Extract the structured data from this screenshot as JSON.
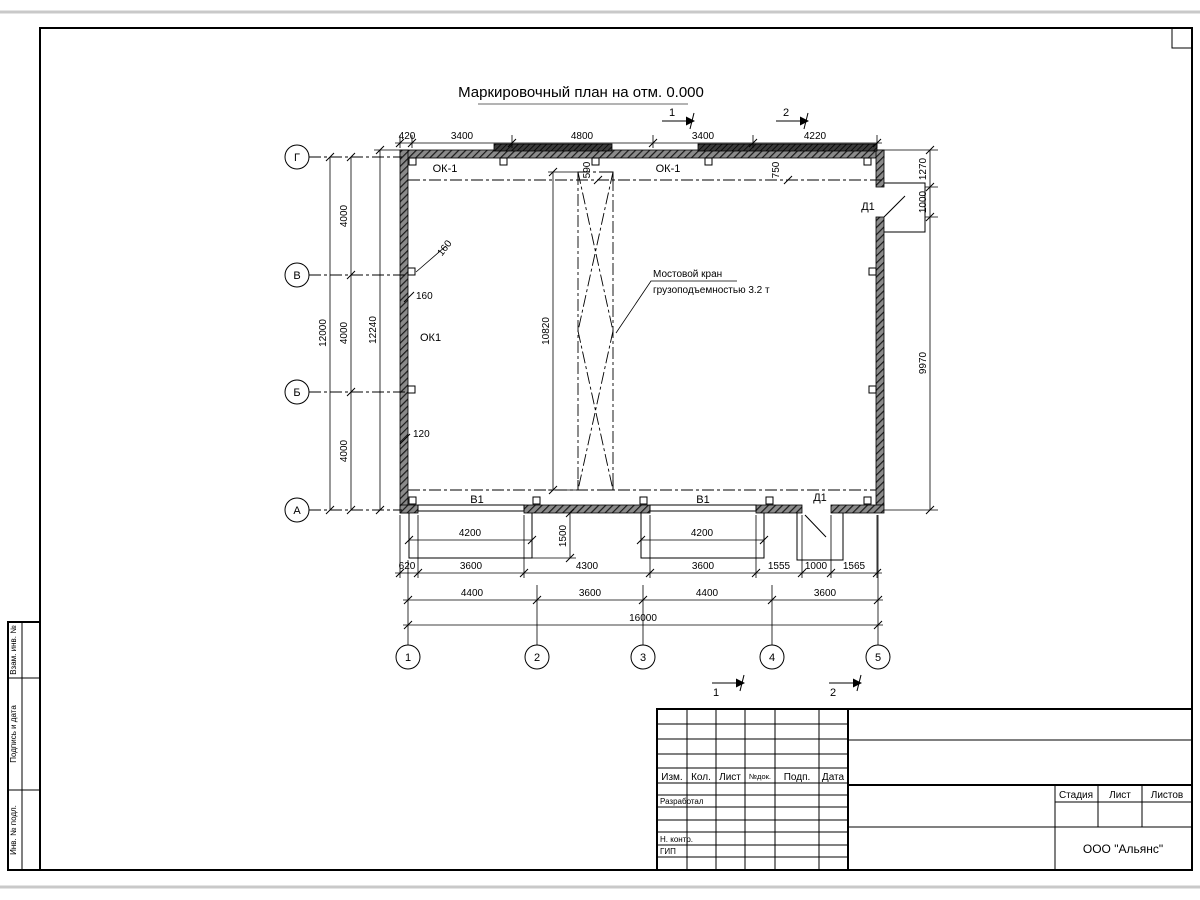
{
  "title": "Маркировочный план на отм. 0.000",
  "axes": {
    "cols": [
      "1",
      "2",
      "3",
      "4",
      "5"
    ],
    "rows": [
      "Г",
      "В",
      "Б",
      "А"
    ]
  },
  "dims": {
    "top": [
      "420",
      "3400",
      "4800",
      "3400",
      "4220"
    ],
    "left": {
      "total": "12000",
      "spans": [
        "4000",
        "4000",
        "4000"
      ],
      "overall": "12240"
    },
    "right": [
      "1270",
      "1000",
      "9970"
    ],
    "crane": {
      "length": "10820",
      "offset_left": "590",
      "offset_right": "750"
    },
    "wall_leaders": [
      "160",
      "160",
      "120"
    ],
    "aprons": [
      "4200",
      "4200"
    ],
    "apron_depth": "1500",
    "bottom_row1": [
      "620",
      "3600",
      "4300",
      "3600",
      "1555",
      "1000",
      "1565"
    ],
    "bottom_row2": [
      "4400",
      "3600",
      "4400",
      "3600"
    ],
    "bottom_total": "16000"
  },
  "marks": {
    "windows_top": [
      "ОК-1",
      "ОК-1"
    ],
    "window_left": "ОК1",
    "gates": [
      "В1",
      "В1"
    ],
    "doors": [
      "Д1",
      "Д1"
    ]
  },
  "crane_note": {
    "line1": "Мостовой кран",
    "line2": "грузоподъемностью 3.2 т"
  },
  "sections": {
    "top": [
      "1",
      "2"
    ],
    "bottom": [
      "1",
      "2"
    ]
  },
  "titleblock": {
    "cols": [
      "Изм.",
      "Кол.",
      "Лист",
      "№док.",
      "Подп.",
      "Дата"
    ],
    "roles": [
      "Разработал",
      "Н. контр.",
      "ГИП"
    ],
    "stage_cols": [
      "Стадия",
      "Лист",
      "Листов"
    ],
    "company": "ООО \"Альянс\""
  },
  "margin_labels": [
    "Взам. инв. №",
    "Подпись и дата",
    "Инв. № подл."
  ]
}
